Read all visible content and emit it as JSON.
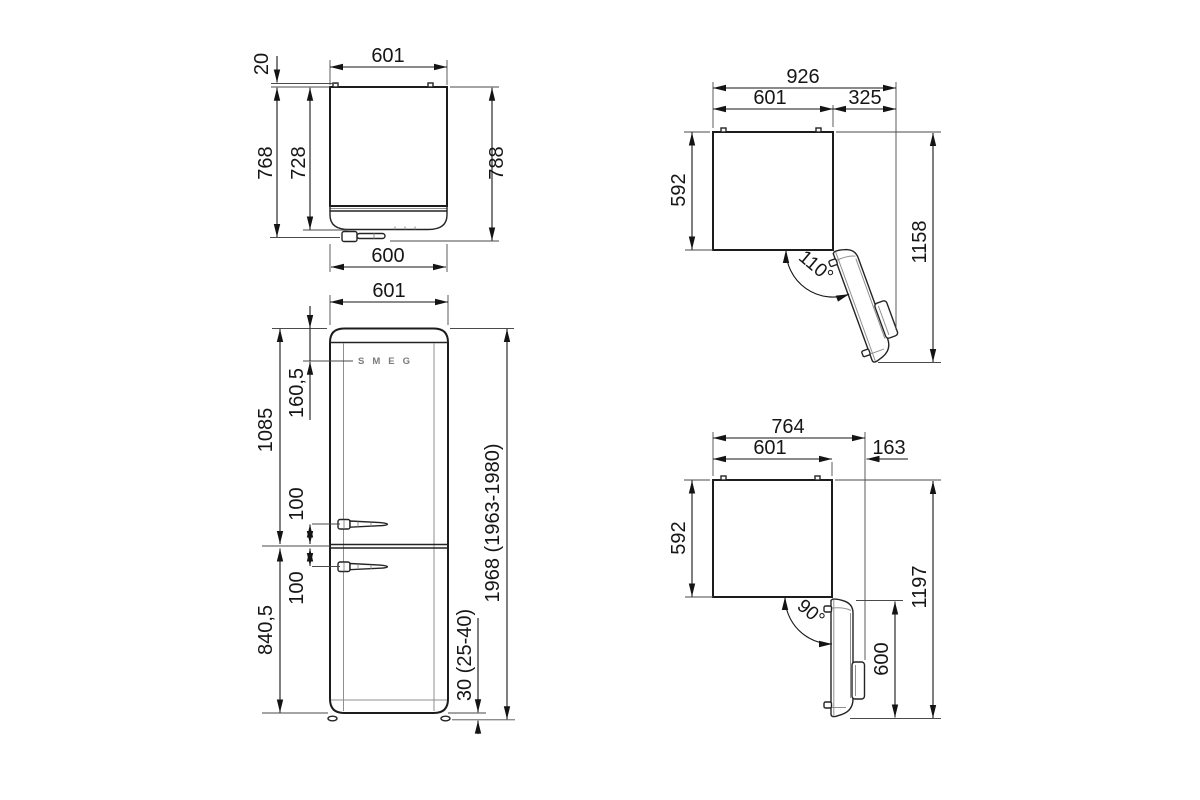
{
  "style": {
    "line_color": "#1a1a1a",
    "detail_color": "#8f8f8f",
    "logo_color": "#7b7b7b"
  },
  "views": {
    "top": {
      "width": "601",
      "rear_clearance": "20",
      "depth_with_door": "768",
      "depth_body": "728",
      "depth_with_handle": "788",
      "door_width": "600"
    },
    "front": {
      "width": "601",
      "logo": "SMEG",
      "logo_offset": "160,5",
      "upper_section": "1085",
      "upper_handle_offset": "100",
      "lower_handle_offset": "100",
      "lower_section": "840,5",
      "feet_height": "30 (25-40)",
      "total_height": "1968 (1963-1980)"
    },
    "open110": {
      "overall_width": "926",
      "body_width": "601",
      "door_overhang": "325",
      "depth": "592",
      "overall_depth": "1158",
      "angle": "110°"
    },
    "open90": {
      "overall_width": "764",
      "body_width": "601",
      "door_overhang": "163",
      "depth": "592",
      "door_width": "600",
      "overall_depth": "1197",
      "angle": "90°"
    }
  }
}
